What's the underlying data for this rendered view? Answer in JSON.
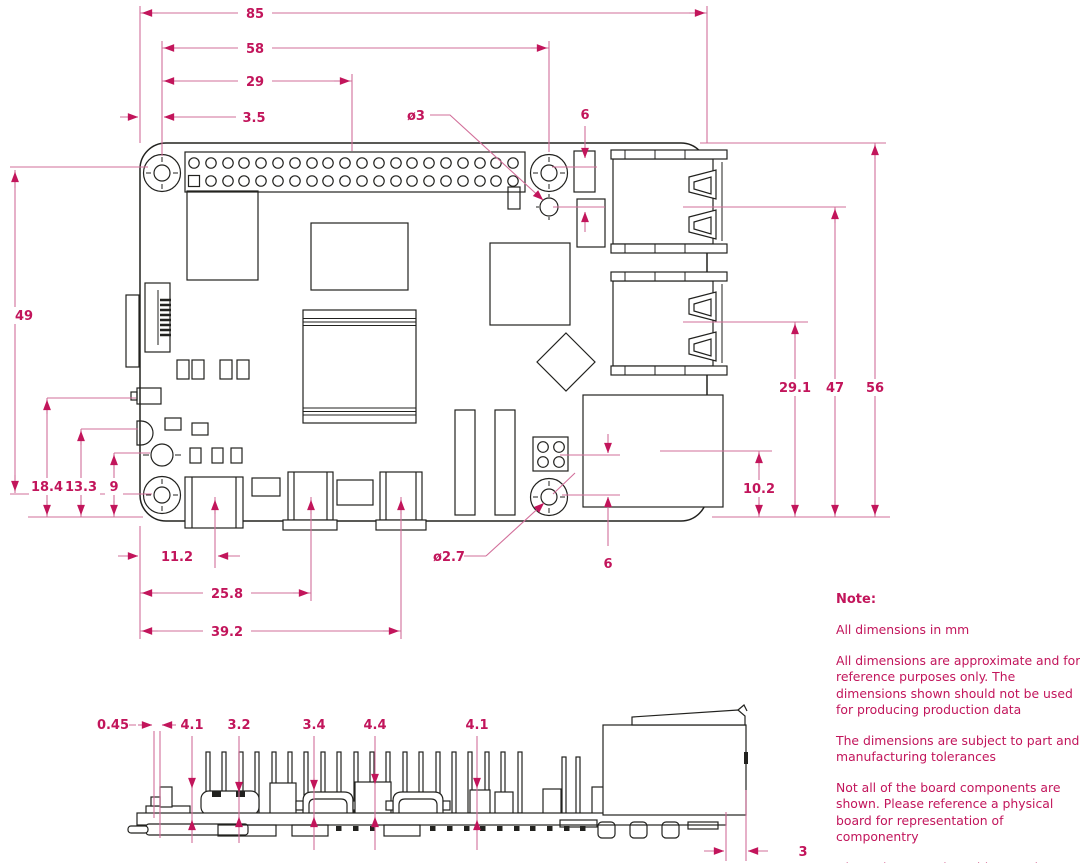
{
  "drawing_title": "Raspberry Pi board dimension drawing",
  "units": "mm",
  "dims": {
    "top": {
      "overall_width": "85",
      "hole_span": "58",
      "gpio_center": "29",
      "hole_offset": "3.5",
      "hole_diameter": "ø3",
      "pad_offset": "6"
    },
    "left": {
      "hole_span_y": "49",
      "comp_a": "18.4",
      "comp_b": "13.3",
      "comp_c": "9"
    },
    "bottom": {
      "usb_c_center": "11.2",
      "hdmi0_center": "25.8",
      "hdmi1_center": "39.2",
      "hole_diameter": "ø2.7",
      "pad_offset": "6"
    },
    "right": {
      "usb_lower_center": "29.1",
      "usb_upper_center": "47",
      "board_depth": "56",
      "ethernet_center": "10.2"
    },
    "side": {
      "sd_overhang": "0.45",
      "bracket_height": "4.1",
      "usb_c_height": "3.2",
      "hdmi_height": "3.4",
      "component_height": "4.4",
      "bracket_height_2": "4.1",
      "usb_overhang": "3"
    }
  },
  "note": {
    "title": "Note:",
    "lines": [
      "All dimensions in mm",
      "All dimensions are approximate and for reference purposes only. The dimensions shown should not be used for producing production data",
      "The dimensions are subject to part and manufacturing tolerances",
      "Not all of the board components are shown. Please reference a physical board for representation of componentry",
      "Dimensions may be subject to change"
    ]
  },
  "colors": {
    "dimension_text": "#c2155b",
    "dimension_line": "#d26f9a",
    "drawing_line": "#22221f",
    "background": "#ffffff"
  }
}
